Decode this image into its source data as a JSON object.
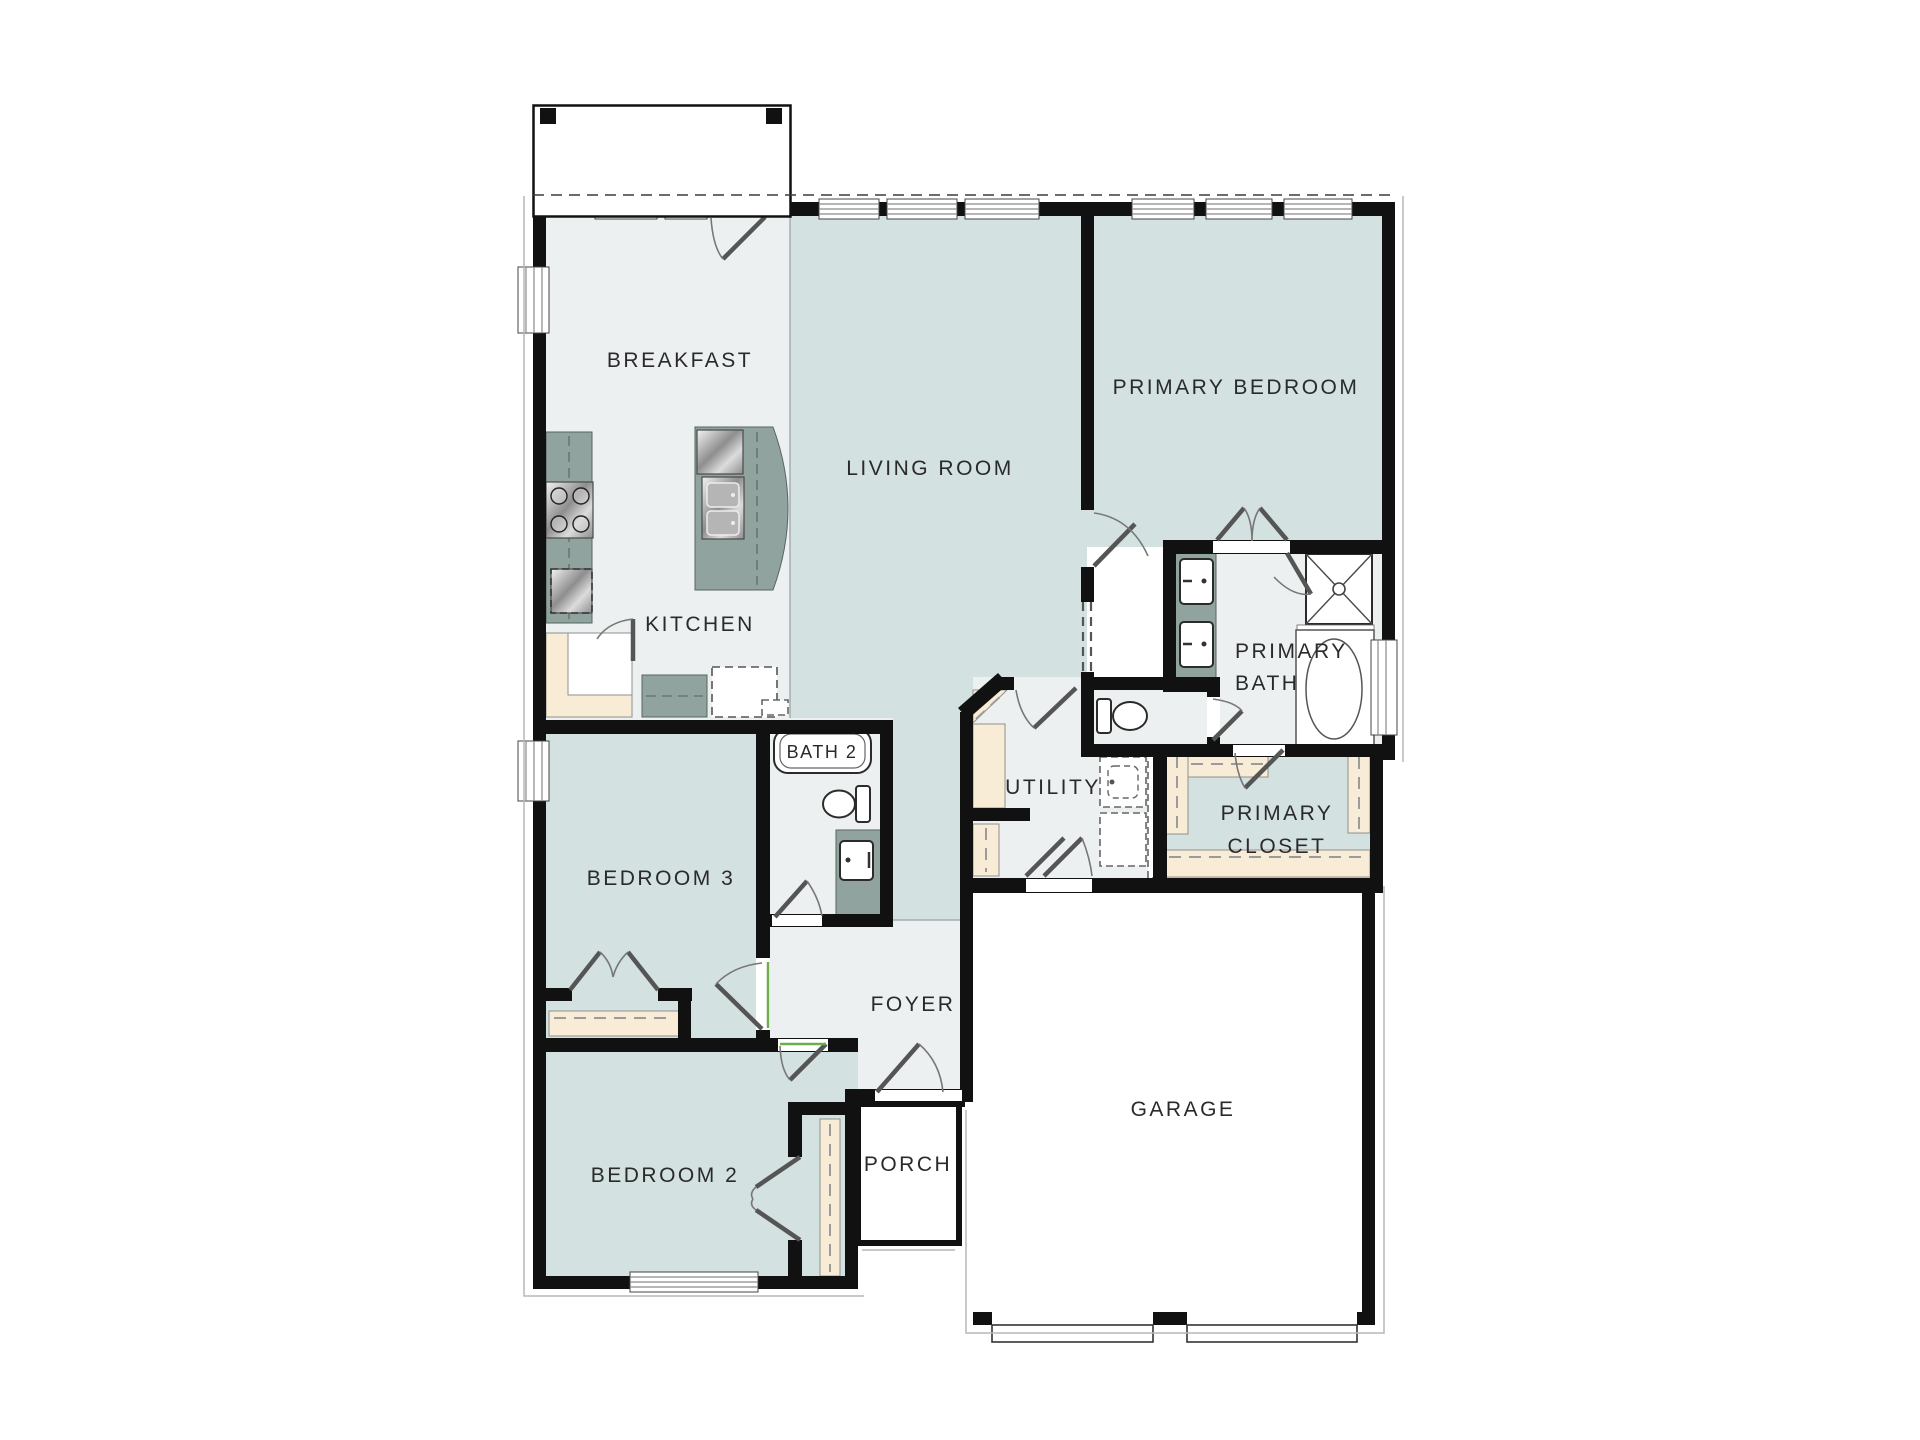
{
  "colors": {
    "wall": "#111111",
    "teal": "#d3e1e0",
    "gray": "#edf0f1",
    "counter": "#90a39e",
    "tan": "#f8ecd7",
    "metal-light": "#f2f2f2",
    "metal-dark": "#8e8e8e",
    "leaf": "#555555",
    "arc": "#777777",
    "green": "#6fae4e",
    "text": "#2a2a2a"
  },
  "floor_plan": {
    "rooms": {
      "breakfast": {
        "label": "BREAKFAST"
      },
      "living_room": {
        "label": "LIVING ROOM"
      },
      "primary_bedroom": {
        "label": "PRIMARY BEDROOM"
      },
      "kitchen": {
        "label": "KITCHEN"
      },
      "bath2": {
        "label": "BATH 2"
      },
      "bedroom3": {
        "label": "BEDROOM 3"
      },
      "utility": {
        "label": "UTILITY"
      },
      "primary_bath": {
        "line1": "PRIMARY",
        "line2": "BATH"
      },
      "primary_closet": {
        "line1": "PRIMARY",
        "line2": "CLOSET"
      },
      "foyer": {
        "label": "FOYER"
      },
      "bedroom2": {
        "label": "BEDROOM 2"
      },
      "porch": {
        "label": "PORCH"
      },
      "garage": {
        "label": "GARAGE"
      }
    },
    "fixtures": [
      "range-icon",
      "dishwasher-icon",
      "island-sink-icon",
      "refrigerator-icon",
      "pantry-shelf",
      "bathtub-icon",
      "toilet-icon",
      "vanity-sink-icon",
      "shower-icon",
      "soaking-tub-icon",
      "double-vanity-icon",
      "washer-dryer-icon",
      "closet-shelf",
      "window",
      "door-swing",
      "garage-door",
      "porch-outline",
      "patio-outline"
    ]
  }
}
